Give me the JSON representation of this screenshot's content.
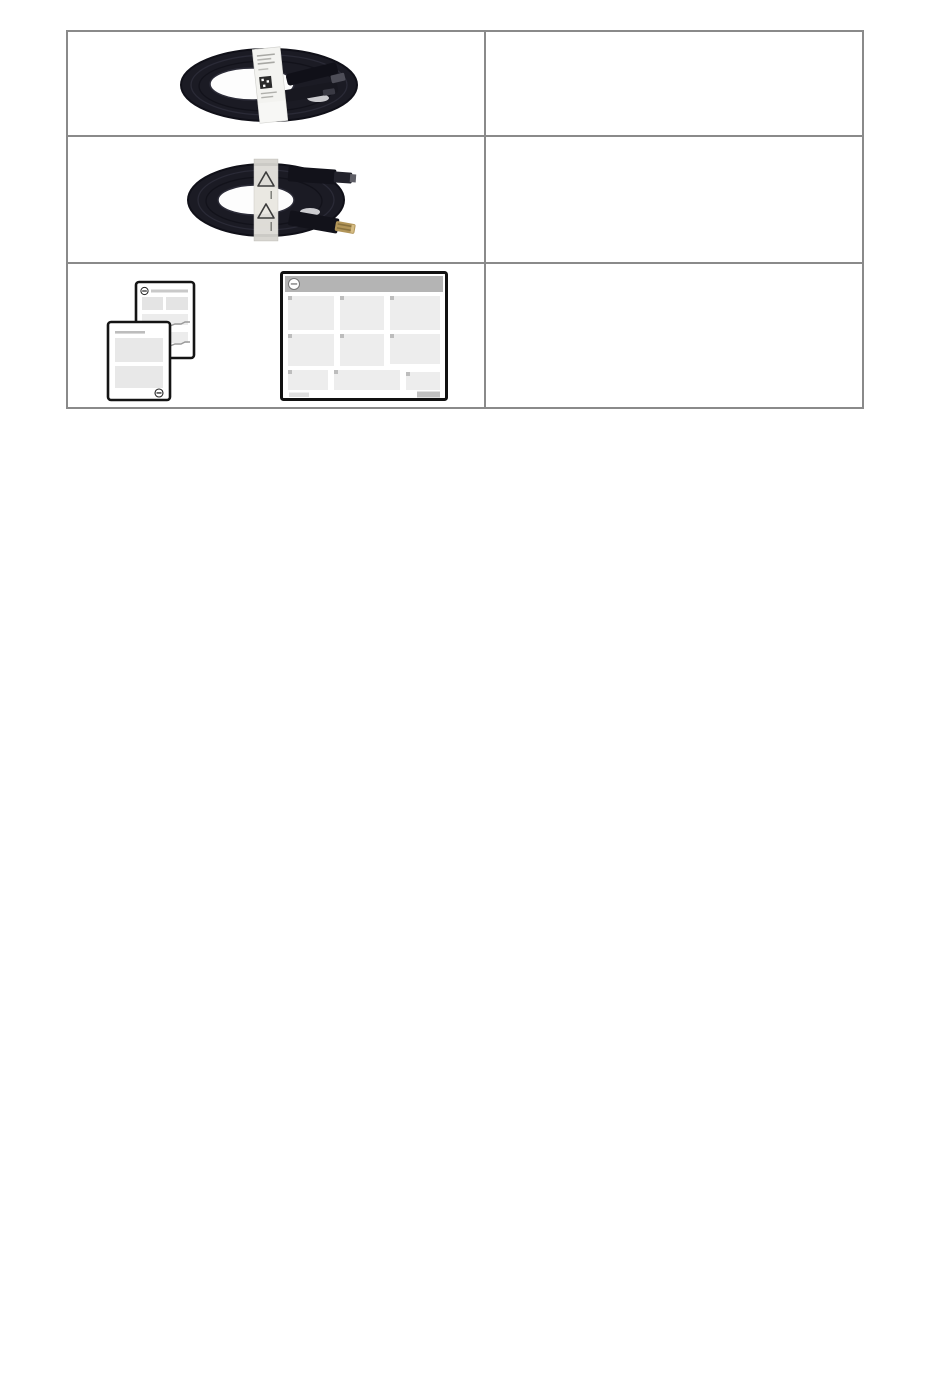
{
  "page": {
    "background_color": "#ffffff",
    "visible_text": ""
  },
  "table": {
    "border_color": "#8a8a8a",
    "column_count": 2,
    "row_count": 3,
    "rows": [
      {
        "left_cell": {
          "image_name": "displayport-cable-photo",
          "label_text": ""
        },
        "right_cell": {
          "text": ""
        }
      },
      {
        "left_cell": {
          "image_name": "hdmi-cable-photo",
          "label_text": ""
        },
        "right_cell": {
          "text": ""
        }
      },
      {
        "left_cell": {
          "image_names": [
            "documents-illustration",
            "quick-setup-guide-illustration"
          ],
          "label_text": ""
        },
        "right_cell": {
          "text": ""
        }
      }
    ]
  },
  "colors": {
    "table_border": "#8a8a8a",
    "cable_dark": "#1b1b24",
    "cable_label_white": "#f3f3f0",
    "wrap_label_tint": "#e9e7e1",
    "hdmi_gold": "#b29559",
    "document_border": "#141414",
    "placeholder_block_gray": "#e8e8e8",
    "guide_header_gray": "#b4b4b4",
    "guide_badge_gray": "#bdbdbd"
  }
}
